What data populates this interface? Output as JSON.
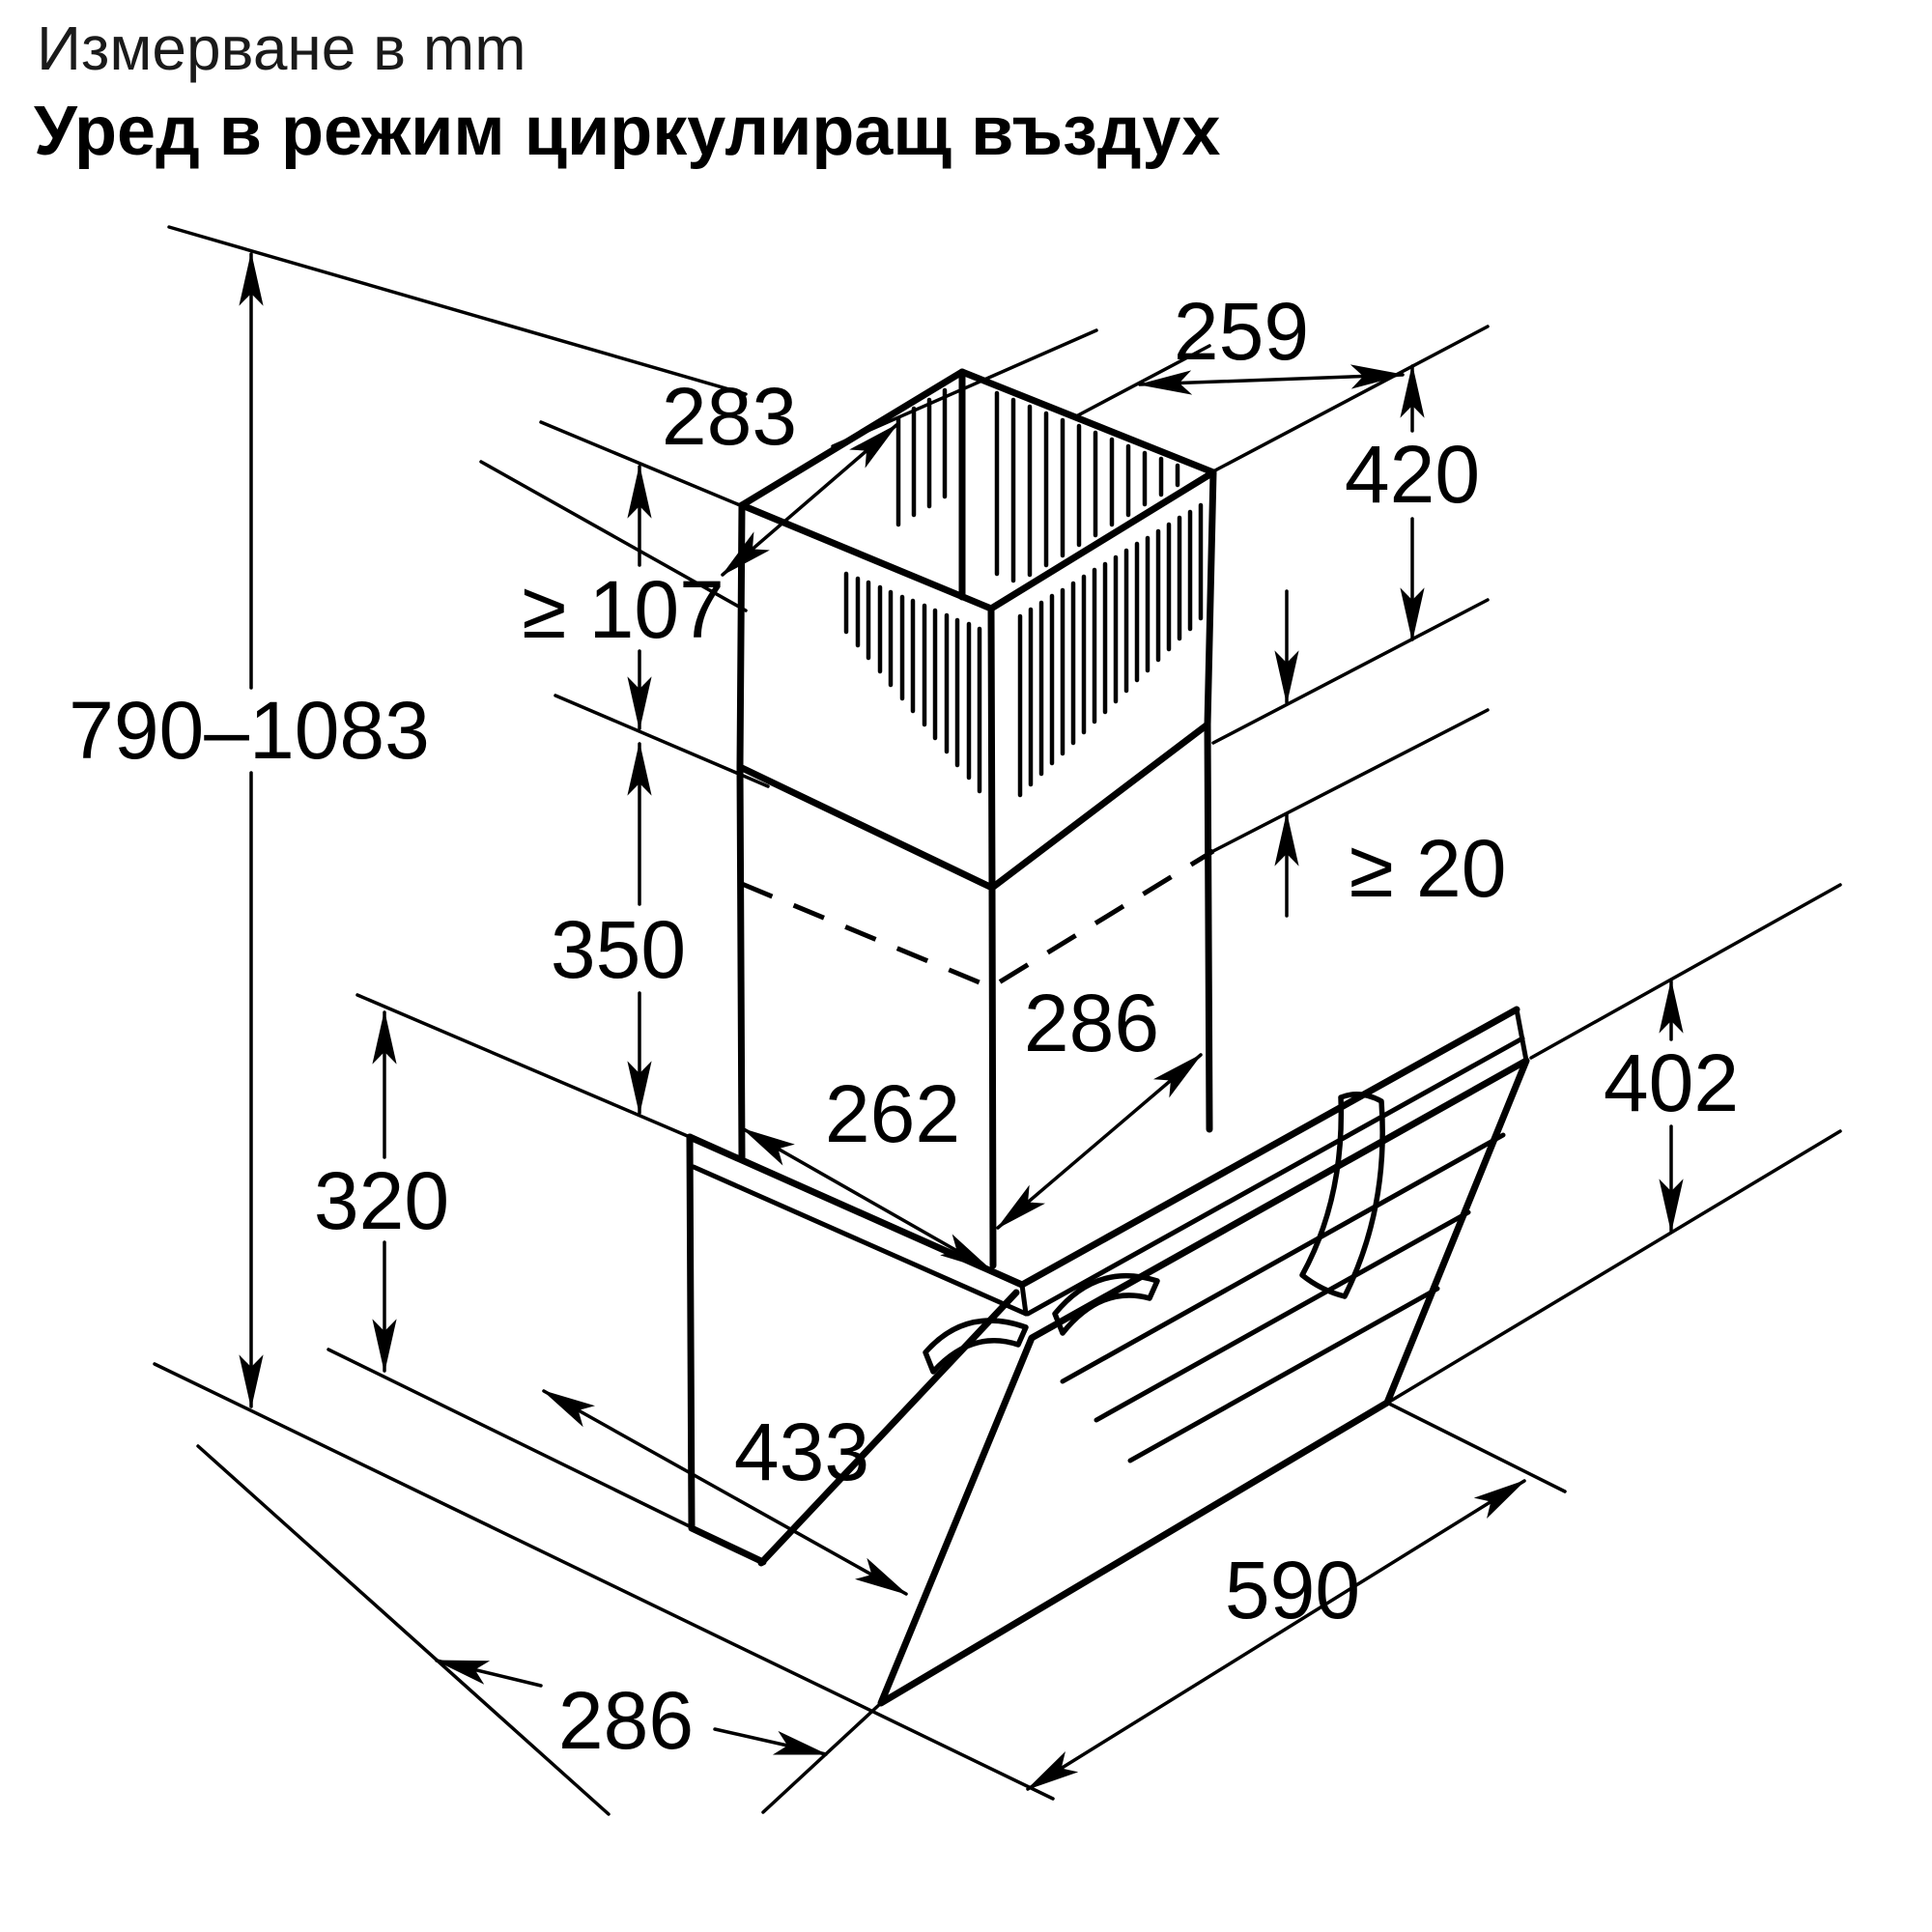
{
  "title": {
    "line1": "Измерване в mm",
    "line2": "Уред в режим циркулиращ въздух"
  },
  "units": "mm",
  "dims": {
    "chimney_top_depth": "283",
    "chimney_top_width": "259",
    "upper_flue_height": "420",
    "min_overlap": "≥ 107",
    "total_height_range": "790–1083",
    "lower_flue_height": "350",
    "min_clearance": "≥ 20",
    "lower_chimney_width": "286",
    "lower_chimney_depth": "262",
    "body_height": "320",
    "glass_height": "402",
    "top_depth": "433",
    "glass_width": "590",
    "bottom_depth": "286"
  }
}
